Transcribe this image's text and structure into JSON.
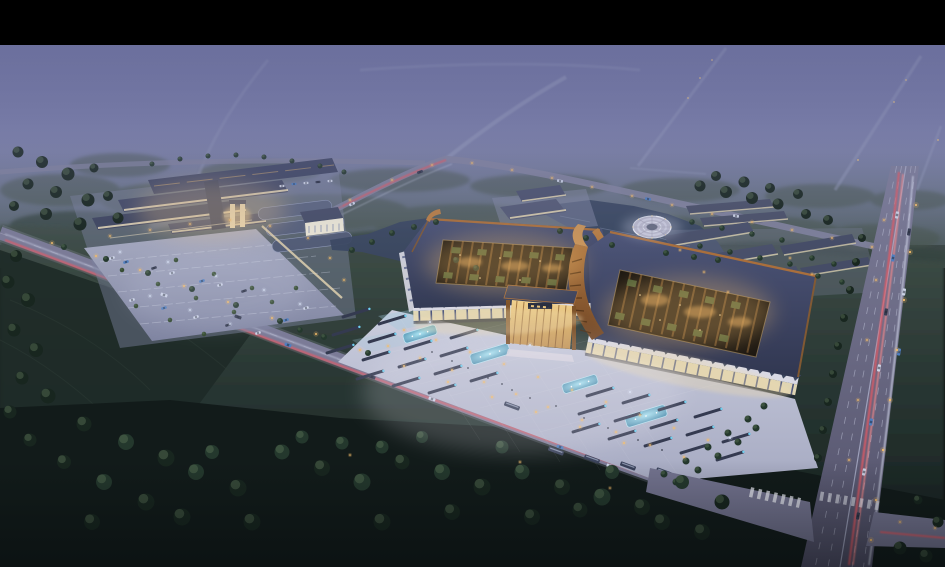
{
  "meta": {
    "kind": "architectural rendering",
    "view": "aerial oblique bird's-eye",
    "time_of_day": "dusk / night",
    "canvas": {
      "width": 945,
      "height": 567
    },
    "letterbox_top_height": 45
  },
  "scene": {
    "features": {
      "main_complex": "twin exhibition halls with dark curved-eave roofs, open lattice courtyards glowing amber with green roof strips",
      "central_gate": "illuminated amber entry pavilion between the two halls",
      "plaza": "bright forecourt with cyan fountain pools, bus bays and lamp points",
      "left_complex": "retail market cluster with parallel roofs, lit facades and a striped parking lot",
      "lake": "landscaped pond behind the halls with a circular terraced island stage",
      "market_rows": "rows of long shop buildings east of the lake",
      "highway": "wide arterial road on the right with red light trails",
      "front_road": "diagonal boulevard with red and white light trails across the foreground",
      "surroundings": "misty purple haze, distant roads, dark farmland and woodland"
    }
  },
  "palette": {
    "letterbox": "#000000",
    "sky_top": "#63679a",
    "sky_mid": "#7e82ad",
    "sky_low": "#76819b",
    "haze": "#7478a0",
    "forest_far": "#3e4c46",
    "ground_top": "#42514b",
    "ground_mid": "#2a3834",
    "ground_dark": "#131d1c",
    "field": "#1e2a27",
    "tree": "#24382d",
    "tree_light": "#33492f",
    "road": "#7b7b97",
    "road_edge": "#b9b9d2",
    "highway_top": "#7d7d99",
    "highway_low": "#515068",
    "plaza_top": "#cdd0e0",
    "plaza_low": "#a6aac2",
    "roof_top": "#4d5578",
    "roof_low": "#343b55",
    "copper": "#a96f3c",
    "copper_bright": "#c8945a",
    "court_dark": "#1d1812",
    "beam": "#6b4e2c",
    "green_roof": "#4e6038",
    "amber_glow": "#e2a95e",
    "facade_lit": "#e9ddb9",
    "fascia": "#d9d9e4",
    "sawtooth": "#3c465e",
    "glass_top": "#f2d492",
    "glass_low": "#c08e4a",
    "pool_center": "#a8e8f6",
    "pool_edge": "#3d84a6",
    "water": "#3b4862",
    "trail_red": "#e25a64",
    "trail_red_hot": "#ff8a8a",
    "trail_white": "#d6dcf2",
    "lamp_warm": "#f3bc6a",
    "lamp_cool": "#d9e3f6"
  }
}
